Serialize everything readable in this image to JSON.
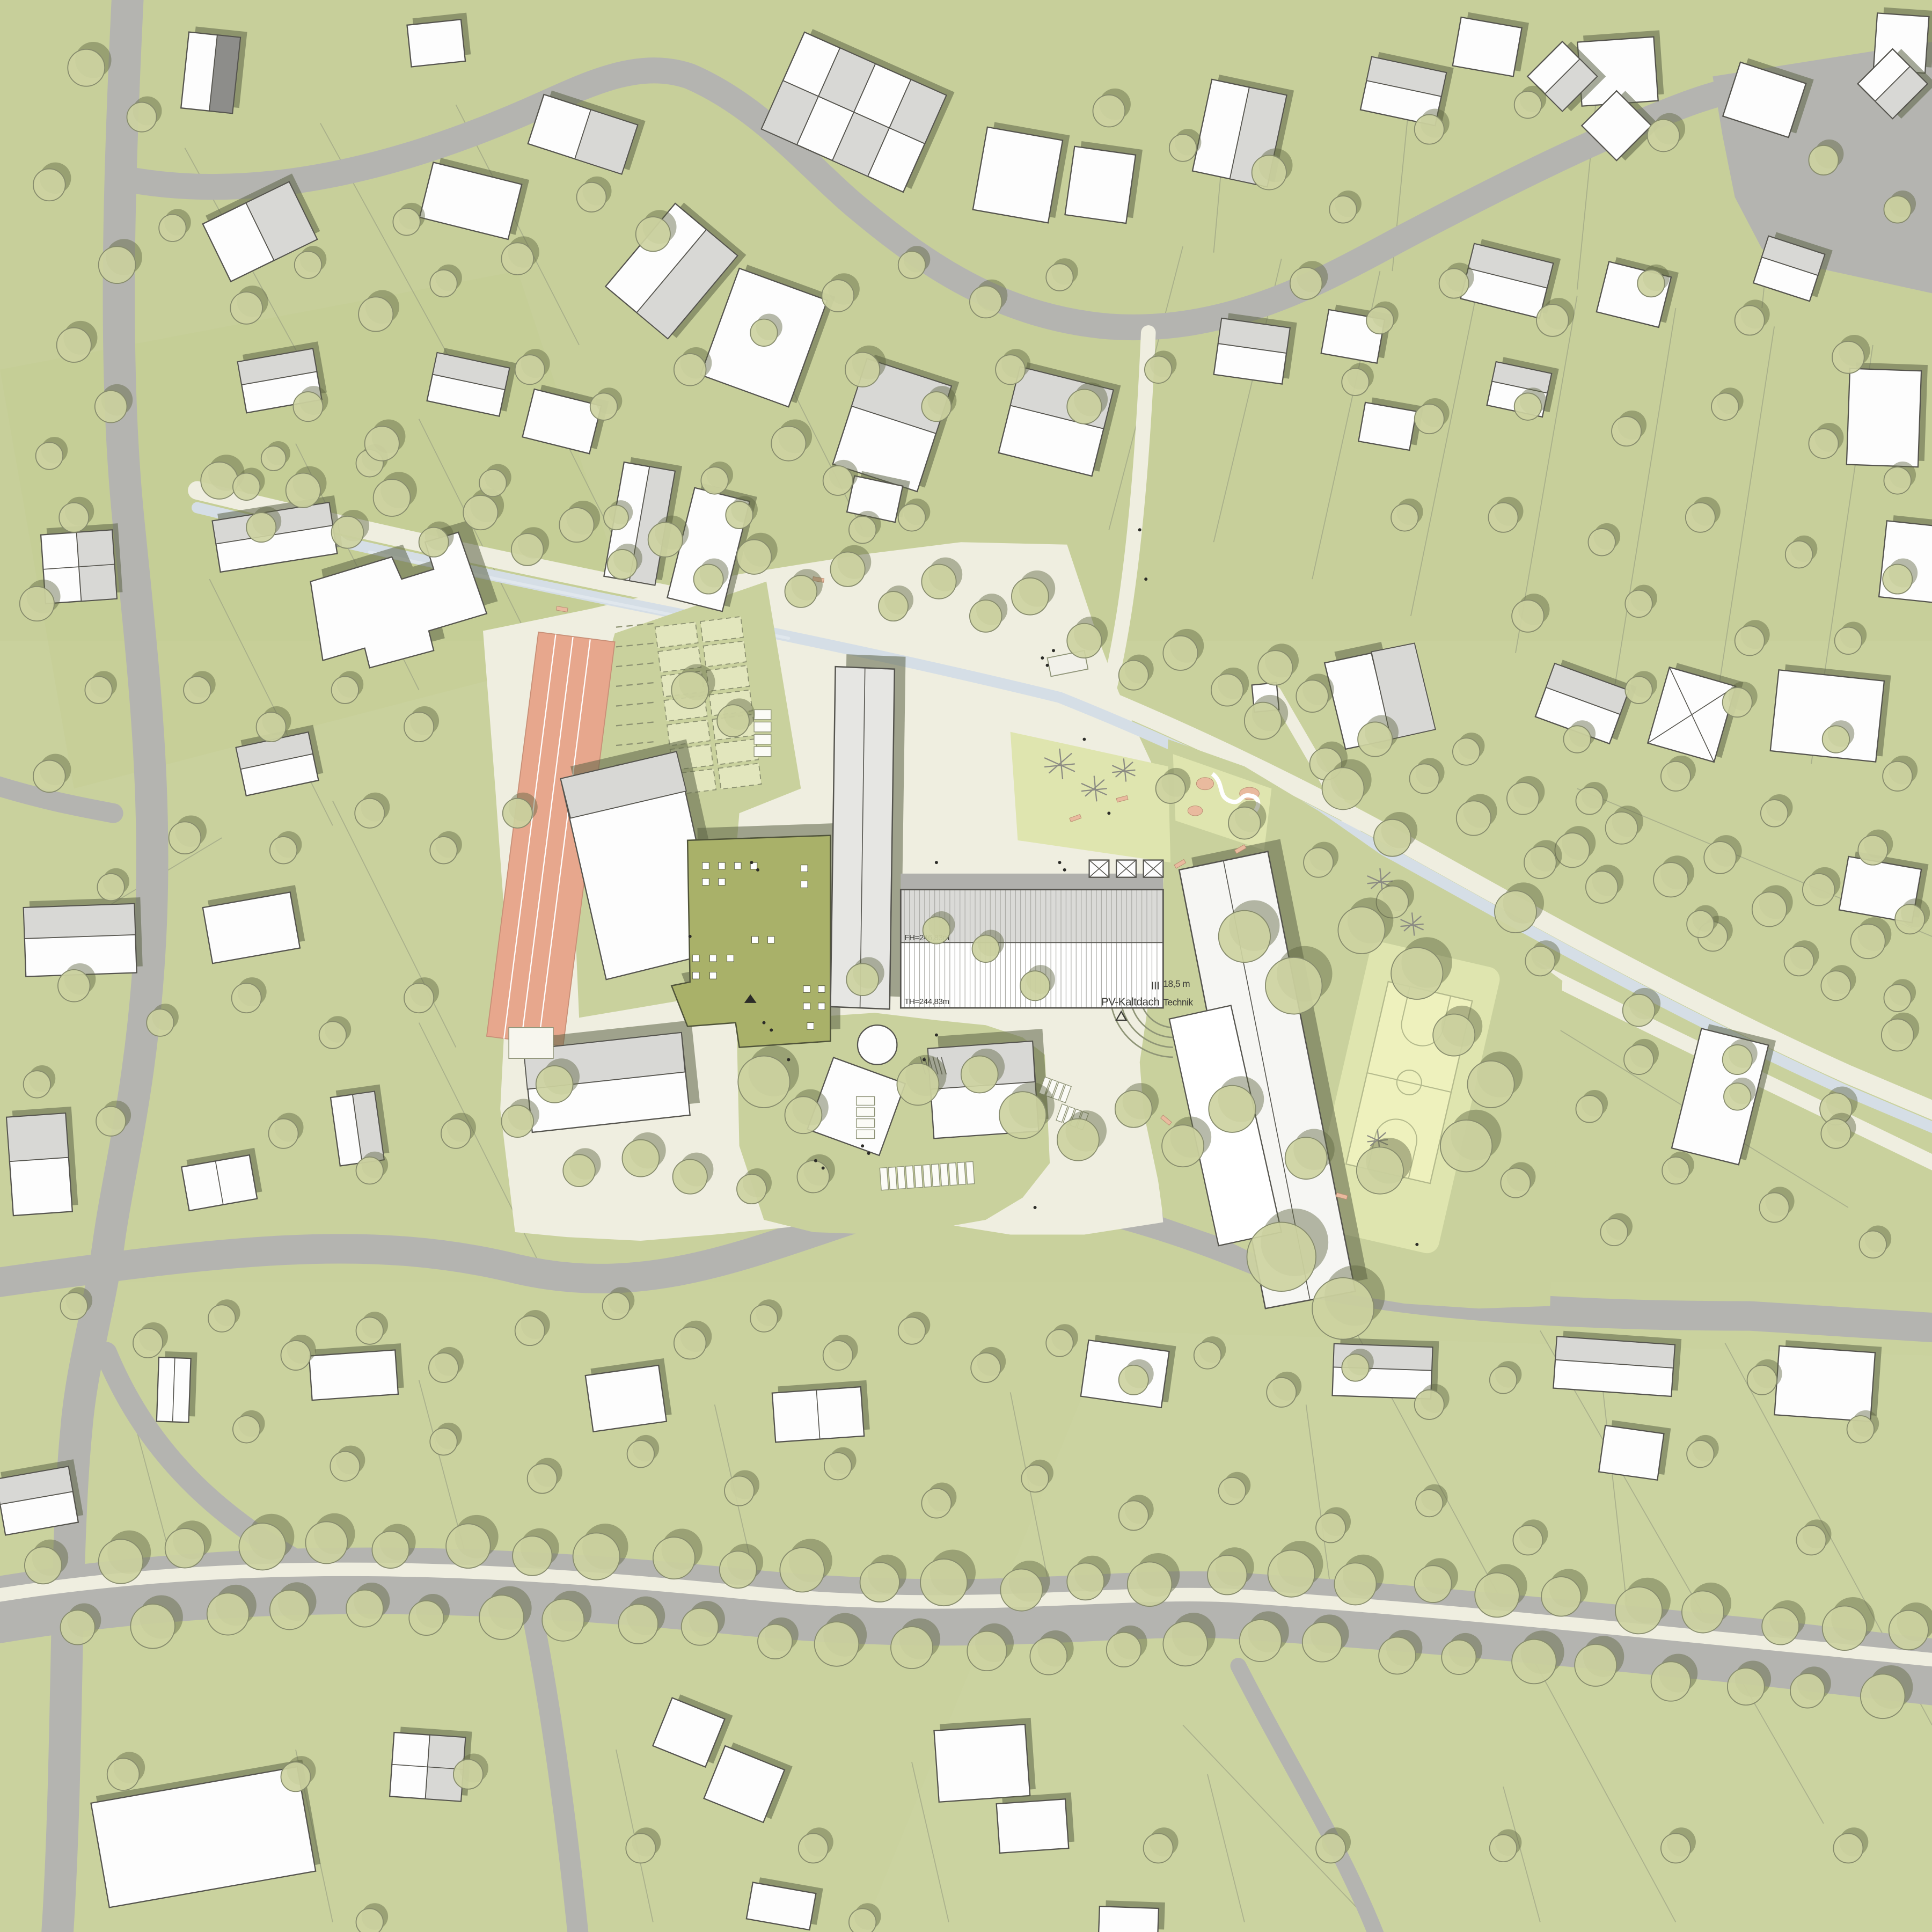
{
  "plan": {
    "type": "architectural-site-plan",
    "labels": {
      "hall_ridge_height": "FH=246,83m",
      "hall_eaves_height": "TH=244,83m",
      "storeys": "III",
      "roof_type": "PV-Kaltdach",
      "technik": "Technik",
      "building_height": "18,5 m"
    },
    "legend_symbols": {
      "entrance_marker": "triangle-icon",
      "trees": "circle-canopy",
      "stream": "light-blue-channel"
    },
    "colors": {
      "grass": "#c9d19d",
      "road": "#b4b4b0",
      "path": "#efeee0",
      "canal": "#d5dee6",
      "treeFill": "#cdd3a1",
      "treeStroke": "#878c6d",
      "treeShadow": "#5f6742",
      "building": "#fdfdfd",
      "buildingGray": "#d8d8d5",
      "buildingDark": "#8d8d8a",
      "buildingStroke": "#55544e",
      "buildingShadow": "#5c6547",
      "greenRoof": "#a9b169",
      "track": "#e7a78d",
      "court": "#eef1bd",
      "lawn": "#dfe5af",
      "sand": "#e9ba9e",
      "hallStripe": "#adada8",
      "label": "#3a3a36",
      "parcel": "#9aa083"
    }
  }
}
